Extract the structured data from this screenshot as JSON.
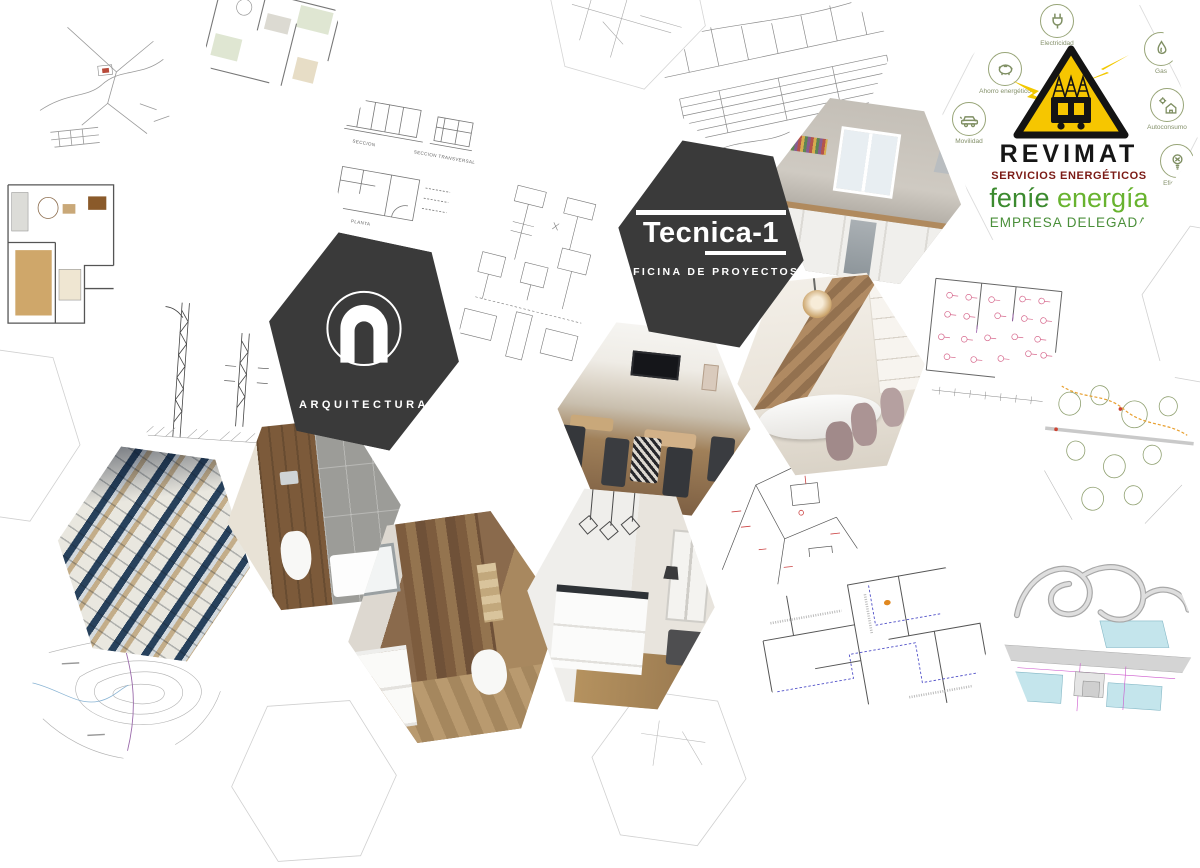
{
  "colors": {
    "dark_hex": "#3a3a3a",
    "revimat_yellow": "#f6c600",
    "revimat_red": "#7b1a15",
    "fenie_green_dark": "#3b8a2e",
    "fenie_green_light": "#68b32f",
    "icon_olive": "#84906a"
  },
  "tecnica": {
    "name": "Tecnica-1",
    "subtitle": "OFICINA DE PROYECTOS"
  },
  "arquitectura": {
    "label": "ARQUITECTURA"
  },
  "revimat": {
    "title": "REVIMAT",
    "subtitle": "SERVICIOS ENERGÉTICOS",
    "brand_first": "feníe",
    "brand_second": "energía",
    "tagline": "EMPRESA DELEGADA",
    "services": [
      {
        "icon": "plug-icon",
        "label": "Electricidad"
      },
      {
        "icon": "piggy-bank-icon",
        "label": "Ahorro energético"
      },
      {
        "icon": "car-icon",
        "label": "Movilidad"
      },
      {
        "icon": "flame-icon",
        "label": "Gas"
      },
      {
        "icon": "solar-house-icon",
        "label": "Autoconsumo"
      },
      {
        "icon": "bulb-icon",
        "label": "Eficiencia"
      }
    ]
  },
  "plan_labels": {
    "section": "SECCION",
    "section_transversal": "SECCION TRANSVERSAL",
    "planta": "PLANTA"
  },
  "tiles": [
    {
      "name": "site-plan-top-left",
      "kind": "plan"
    },
    {
      "name": "floor-plan-green-top",
      "kind": "plan"
    },
    {
      "name": "section-drawing",
      "kind": "plan"
    },
    {
      "name": "terrain-profile",
      "kind": "plan"
    },
    {
      "name": "kitchen-photo-1",
      "kind": "photo"
    },
    {
      "name": "revimat-logo",
      "kind": "logo"
    },
    {
      "name": "colored-floor-plan",
      "kind": "plan"
    },
    {
      "name": "pylon-detail-drawing",
      "kind": "plan"
    },
    {
      "name": "arquitectura-logo",
      "kind": "logo"
    },
    {
      "name": "electrical-schematic",
      "kind": "plan"
    },
    {
      "name": "tecnica1-logo",
      "kind": "logo"
    },
    {
      "name": "dining-room-photo",
      "kind": "photo"
    },
    {
      "name": "staircase-dining-photo",
      "kind": "photo"
    },
    {
      "name": "electrical-floor-plan-pink",
      "kind": "plan"
    },
    {
      "name": "landscape-plan",
      "kind": "plan"
    },
    {
      "name": "radiant-floor-photo",
      "kind": "photo"
    },
    {
      "name": "bathroom-photo-1",
      "kind": "photo"
    },
    {
      "name": "bathroom-photo-2",
      "kind": "photo"
    },
    {
      "name": "kitchen-photo-2",
      "kind": "photo"
    },
    {
      "name": "site-plan-red-marks",
      "kind": "plan"
    },
    {
      "name": "blueprint-dashed-plan",
      "kind": "plan"
    },
    {
      "name": "karting-track-plan",
      "kind": "plan"
    },
    {
      "name": "topographic-map",
      "kind": "plan"
    },
    {
      "name": "partial-plan-top-center",
      "kind": "plan"
    },
    {
      "name": "ghost-hexagon-left",
      "kind": "ghost"
    },
    {
      "name": "ghost-hexagon-bottom-1",
      "kind": "ghost"
    },
    {
      "name": "ghost-hexagon-bottom-2",
      "kind": "ghost"
    },
    {
      "name": "ghost-hexagon-right",
      "kind": "ghost"
    }
  ]
}
